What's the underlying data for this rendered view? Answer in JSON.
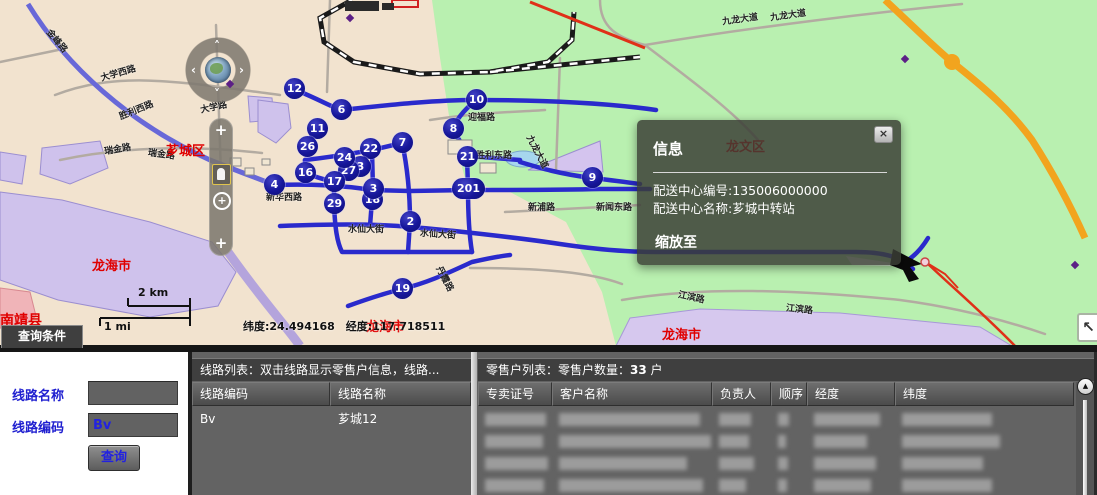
{
  "colors": {
    "accent_blue": "#2a2acc",
    "marker_navy": "#12127e",
    "panel_gray": "#636363",
    "header_gray": "#3f3f3f",
    "map_green": "#b9f0b0",
    "map_cream": "#f2e3cf",
    "map_lavender": "#cfc2ec",
    "highway_orange": "#f2a41e",
    "district_label_red": "#e00000"
  },
  "map": {
    "popup": {
      "title": "信息",
      "line1": "配送中心编号:135006000000",
      "line2": "配送中心名称:芗城中转站",
      "action": "缩放至",
      "close": "×"
    },
    "coords_text": "纬度:24.494168　经度:117.718511",
    "scale_km": "2 km",
    "scale_mi": "1 mi",
    "expand_icon": "↖",
    "scroll_up_icon": "▲",
    "zoom_in_icon": "+",
    "markers": [
      {
        "n": "12",
        "x": 294,
        "y": 88
      },
      {
        "n": "6",
        "x": 341,
        "y": 109
      },
      {
        "n": "11",
        "x": 317,
        "y": 128
      },
      {
        "n": "26",
        "x": 307,
        "y": 146
      },
      {
        "n": "22",
        "x": 370,
        "y": 148
      },
      {
        "n": "7",
        "x": 402,
        "y": 142
      },
      {
        "n": "10",
        "x": 476,
        "y": 99
      },
      {
        "n": "8",
        "x": 453,
        "y": 128
      },
      {
        "n": "21",
        "x": 467,
        "y": 156
      },
      {
        "n": "9",
        "x": 592,
        "y": 177
      },
      {
        "n": "201",
        "x": 468,
        "y": 188,
        "wide": true
      },
      {
        "n": "4",
        "x": 274,
        "y": 184
      },
      {
        "n": "16",
        "x": 305,
        "y": 172
      },
      {
        "n": "3",
        "x": 360,
        "y": 166
      },
      {
        "n": "27",
        "x": 348,
        "y": 170
      },
      {
        "n": "24",
        "x": 344,
        "y": 157
      },
      {
        "n": "17",
        "x": 334,
        "y": 181
      },
      {
        "n": "29",
        "x": 334,
        "y": 203
      },
      {
        "n": "18",
        "x": 372,
        "y": 199
      },
      {
        "n": "3",
        "x": 373,
        "y": 188
      },
      {
        "n": "2",
        "x": 410,
        "y": 221
      },
      {
        "n": "19",
        "x": 402,
        "y": 288
      }
    ],
    "region_labels": [
      {
        "t": "南靖县",
        "x": 0,
        "y": 310,
        "s": 14
      },
      {
        "t": "芗城区",
        "x": 166,
        "y": 140,
        "s": 13
      },
      {
        "t": "龙海市",
        "x": 92,
        "y": 255,
        "s": 13
      },
      {
        "t": "龙海市",
        "x": 366,
        "y": 316,
        "s": 13
      },
      {
        "t": "龙海市",
        "x": 662,
        "y": 324,
        "s": 13
      },
      {
        "t": "龙文区",
        "x": 726,
        "y": 136,
        "s": 13
      }
    ],
    "road_labels": [
      {
        "t": "金峰路",
        "x": 44,
        "y": 34,
        "r": 50
      },
      {
        "t": "大学西路",
        "x": 100,
        "y": 66,
        "r": -16
      },
      {
        "t": "大学路",
        "x": 200,
        "y": 100,
        "r": -12
      },
      {
        "t": "胜利西路",
        "x": 118,
        "y": 103,
        "r": -22
      },
      {
        "t": "瑞金路",
        "x": 104,
        "y": 142,
        "r": -10
      },
      {
        "t": "瑞金路",
        "x": 148,
        "y": 147,
        "r": 8
      },
      {
        "t": "新华西路",
        "x": 266,
        "y": 190,
        "r": 0
      },
      {
        "t": "水仙大街",
        "x": 348,
        "y": 222,
        "r": 0
      },
      {
        "t": "水仙大街",
        "x": 420,
        "y": 227,
        "r": 4
      },
      {
        "t": "丹霞路",
        "x": 432,
        "y": 272,
        "r": 62
      },
      {
        "t": "迎福路",
        "x": 468,
        "y": 110,
        "r": 0
      },
      {
        "t": "胜利东路",
        "x": 476,
        "y": 148,
        "r": 0
      },
      {
        "t": "九龙大道",
        "x": 520,
        "y": 145,
        "r": 62
      },
      {
        "t": "新浦路",
        "x": 528,
        "y": 200,
        "r": 0
      },
      {
        "t": "新闻东路",
        "x": 596,
        "y": 200,
        "r": 0
      },
      {
        "t": "九龙大道",
        "x": 722,
        "y": 12,
        "r": -8
      },
      {
        "t": "九龙大道",
        "x": 770,
        "y": 8,
        "r": -8
      },
      {
        "t": "江滨路",
        "x": 678,
        "y": 290,
        "r": 12
      },
      {
        "t": "江滨路",
        "x": 786,
        "y": 302,
        "r": 6
      }
    ]
  },
  "query_panel": {
    "tab": "查询条件",
    "route_name_label": "线路名称",
    "route_name_value": "",
    "route_code_label": "线路编码",
    "route_code_value": "Bv",
    "search_button": "查询"
  },
  "route_list": {
    "title": "线路列表：双击线路显示零售户信息，线路...",
    "columns": [
      "线路编码",
      "线路名称"
    ],
    "col_widths": [
      138,
      141
    ],
    "rows": [
      [
        "Bv",
        "芗城12"
      ]
    ]
  },
  "retailer_list": {
    "title_prefix": "零售户列表：零售户数量：",
    "count": "33",
    "title_suffix": " 户",
    "columns": [
      "专卖证号",
      "客户名称",
      "负责人",
      "顺序",
      "经度",
      "纬度"
    ],
    "col_widths": [
      74,
      160,
      59,
      36,
      88,
      179
    ],
    "redacted_row_count": 4
  }
}
